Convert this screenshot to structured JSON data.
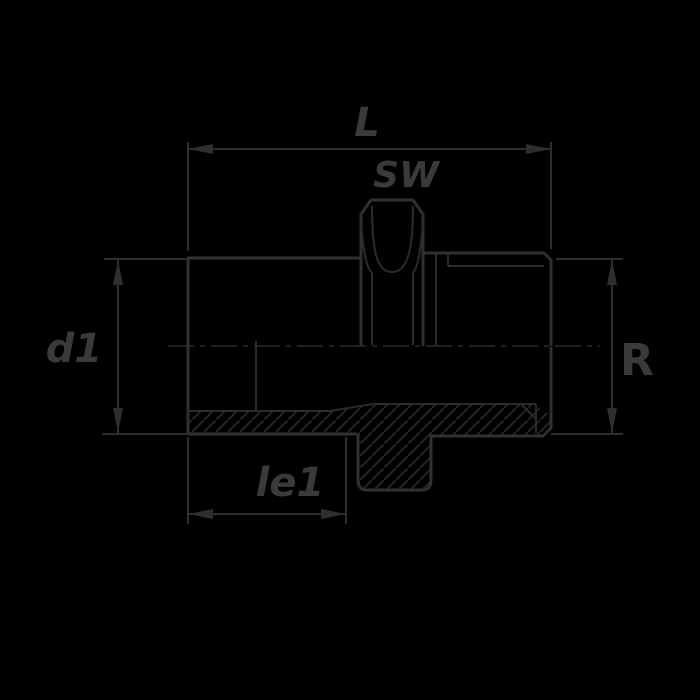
{
  "drawing": {
    "type": "technical-section-drawing",
    "subject": "threaded-pipe-fitting",
    "background_color": "#000000",
    "line_color": "#2f2f2f",
    "text_color": "#3a3a3a",
    "labels": {
      "overall_length": "L",
      "wrench_size": "SW",
      "inner_diameter": "d1",
      "thread_size": "R",
      "thread_length": "le1"
    }
  }
}
